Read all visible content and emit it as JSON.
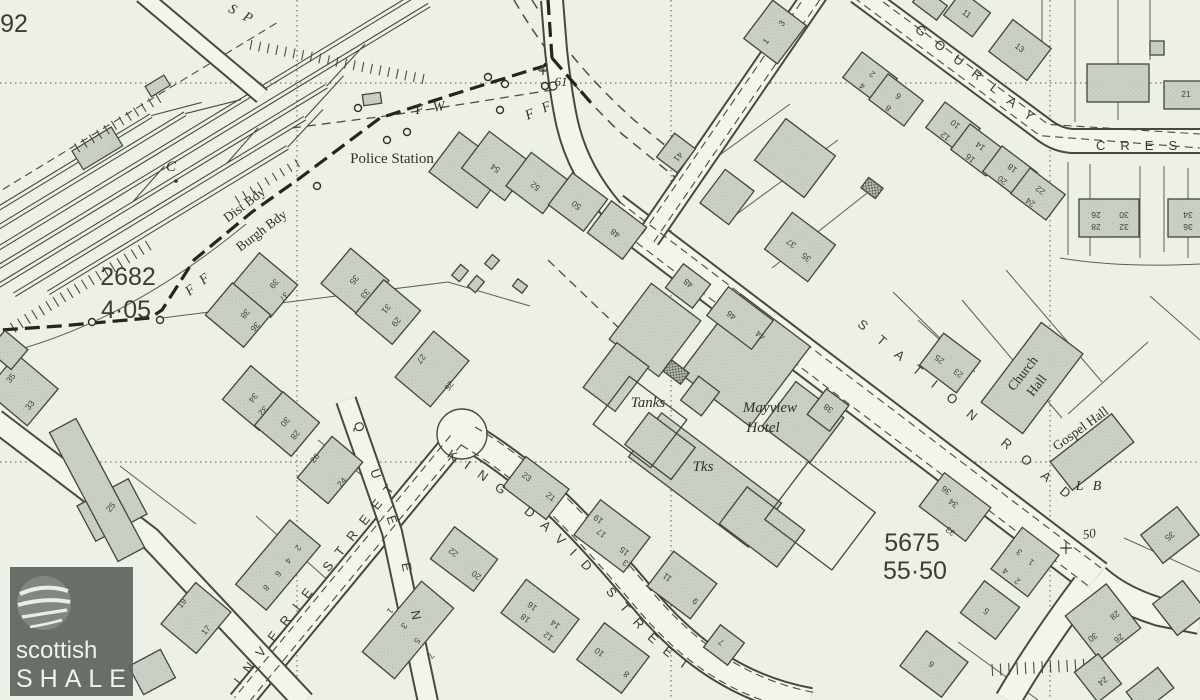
{
  "colors": {
    "paper": "#edf0e6",
    "ink": "#474b42",
    "building_fill": "#cbd0c6",
    "building_stroke": "#41453c",
    "road_fill": "#f3f5ec",
    "boundary": "#23261f",
    "watermark_bg": "#5f645e",
    "watermark_text": "#f1f2ee"
  },
  "watermark": {
    "line1": "scottish",
    "line2": "SHALE"
  },
  "map": {
    "street_labels": [
      {
        "t": "STATION ROAD",
        "path": "tp-station",
        "fs": 14,
        "sp": 16,
        "off": 40
      },
      {
        "t": "GOURLAY",
        "path": "tp-gourlay",
        "fs": 13,
        "sp": 14,
        "off": 18
      },
      {
        "t": "CRES",
        "path": "tp-cres",
        "fs": 13,
        "sp": 15,
        "off": 8
      },
      {
        "t": "KING DAVID STREET",
        "path": "tp-kingdavid",
        "fs": 13.5,
        "sp": 12,
        "off": 12
      },
      {
        "t": "INVERIE STREET",
        "path": "tp-inverie",
        "fs": 13,
        "sp": 11,
        "off": 26
      },
      {
        "t": "QUEEN",
        "path": "tp-queen",
        "fs": 13,
        "sp": 40,
        "off": 10
      }
    ],
    "place_labels": [
      {
        "t": "92",
        "x": 14,
        "y": 32,
        "r": 0,
        "s": "big"
      },
      {
        "t": "2682",
        "x": 128,
        "y": 285,
        "r": 0,
        "s": "big"
      },
      {
        "t": "4·05",
        "x": 126,
        "y": 318,
        "r": 0,
        "s": "big"
      },
      {
        "t": "5675",
        "x": 912,
        "y": 551,
        "r": 0,
        "s": "big"
      },
      {
        "t": "55·50",
        "x": 915,
        "y": 579,
        "r": 0,
        "s": "big"
      },
      {
        "t": "Police Station",
        "x": 392,
        "y": 163,
        "r": 0,
        "s": "serif"
      },
      {
        "t": "Dist Bdy",
        "x": 247,
        "y": 208,
        "r": -37,
        "s": "serif-s"
      },
      {
        "t": "Burgh Bdy",
        "x": 264,
        "y": 234,
        "r": -37,
        "s": "serif-s"
      },
      {
        "t": "F W",
        "x": 432,
        "y": 112,
        "r": -8,
        "s": "it-sp"
      },
      {
        "t": "F F",
        "x": 541,
        "y": 114,
        "r": -24,
        "s": "it-sp"
      },
      {
        "t": "F F",
        "x": 201,
        "y": 287,
        "r": -38,
        "s": "it-sp"
      },
      {
        "t": "S P",
        "x": 240,
        "y": 18,
        "r": 28,
        "s": "it-sp"
      },
      {
        "t": "C",
        "x": 171,
        "y": 171,
        "r": 0,
        "s": "it"
      },
      {
        "t": "61",
        "x": 561,
        "y": 86,
        "r": 0,
        "s": "it-s"
      },
      {
        "t": "50",
        "x": 1090,
        "y": 538,
        "r": -10,
        "s": "it-s"
      },
      {
        "t": "+",
        "x": 543,
        "y": 76,
        "r": 0,
        "s": "serif"
      },
      {
        "t": "+",
        "x": 1066,
        "y": 553,
        "r": 0,
        "s": "serif"
      },
      {
        "t": "Tanks",
        "x": 648,
        "y": 407,
        "r": 0,
        "s": "it"
      },
      {
        "t": "Tks",
        "x": 703,
        "y": 471,
        "r": 0,
        "s": "it"
      },
      {
        "t": "Mayview",
        "x": 770,
        "y": 412,
        "r": 0,
        "s": "it"
      },
      {
        "t": "Hotel",
        "x": 763,
        "y": 432,
        "r": 0,
        "s": "it"
      },
      {
        "t": "Church",
        "x": 1026,
        "y": 376,
        "r": -52,
        "s": "serif-s"
      },
      {
        "t": "Hall",
        "x": 1040,
        "y": 388,
        "r": -52,
        "s": "serif-s"
      },
      {
        "t": "Gospel Hall",
        "x": 1083,
        "y": 432,
        "r": -36,
        "s": "serif-s"
      },
      {
        "t": "L B",
        "x": 1090,
        "y": 490,
        "r": 0,
        "s": "it-sp"
      }
    ],
    "house_numbers": [
      [
        "54",
        497,
        166,
        -143
      ],
      [
        "52",
        537,
        184,
        -143
      ],
      [
        "50",
        578,
        203,
        -143
      ],
      [
        "48",
        617,
        231,
        -143
      ],
      [
        "37",
        793,
        241,
        -143
      ],
      [
        "35",
        808,
        255,
        -143
      ],
      [
        "25",
        941,
        357,
        -143
      ],
      [
        "23",
        960,
        371,
        -143
      ],
      [
        "2",
        874,
        72,
        -143
      ],
      [
        "4",
        864,
        84,
        -143
      ],
      [
        "6",
        900,
        94,
        -143
      ],
      [
        "8",
        890,
        106,
        -143
      ],
      [
        "10",
        957,
        122,
        -143
      ],
      [
        "12",
        947,
        134,
        -143
      ],
      [
        "14",
        982,
        144,
        -143
      ],
      [
        "16",
        972,
        156,
        -143
      ],
      [
        "18",
        1014,
        166,
        -143
      ],
      [
        "20",
        1004,
        178,
        -143
      ],
      [
        "22",
        1042,
        188,
        -143
      ],
      [
        "24",
        1032,
        200,
        -143
      ],
      [
        "11",
        965,
        16,
        37
      ],
      [
        "13",
        1018,
        50,
        37
      ],
      [
        "21",
        1186,
        97,
        0
      ],
      [
        "26",
        1096,
        212,
        180
      ],
      [
        "28",
        1096,
        224,
        180
      ],
      [
        "30",
        1124,
        212,
        180
      ],
      [
        "32",
        1124,
        224,
        180
      ],
      [
        "34",
        1188,
        212,
        180
      ],
      [
        "36",
        1188,
        224,
        180
      ],
      [
        "1",
        768,
        43,
        -53
      ],
      [
        "3",
        784,
        25,
        -53
      ],
      [
        "41",
        676,
        155,
        130
      ],
      [
        "48",
        690,
        281,
        -143
      ],
      [
        "46",
        733,
        313,
        -143
      ],
      [
        "44",
        762,
        333,
        -143
      ],
      [
        "38",
        830,
        406,
        -143
      ],
      [
        "23",
        525,
        479,
        37
      ],
      [
        "21",
        549,
        499,
        37
      ],
      [
        "22",
        455,
        550,
        -143
      ],
      [
        "20",
        478,
        573,
        -143
      ],
      [
        "19",
        600,
        517,
        -143
      ],
      [
        "17",
        603,
        531,
        -143
      ],
      [
        "15",
        626,
        549,
        -143
      ],
      [
        "13",
        629,
        562,
        -143
      ],
      [
        "16",
        534,
        604,
        -143
      ],
      [
        "18",
        527,
        616,
        -143
      ],
      [
        "14",
        557,
        622,
        -143
      ],
      [
        "12",
        550,
        634,
        -143
      ],
      [
        "10",
        601,
        650,
        -143
      ],
      [
        "8",
        628,
        672,
        -143
      ],
      [
        "11",
        669,
        575,
        -143
      ],
      [
        "9",
        697,
        599,
        -143
      ],
      [
        "7",
        723,
        640,
        -143
      ],
      [
        "5",
        988,
        609,
        -143
      ],
      [
        "6",
        933,
        662,
        -143
      ],
      [
        "4",
        1007,
        569,
        -143
      ],
      [
        "2",
        1019,
        579,
        -143
      ],
      [
        "3",
        1021,
        550,
        -143
      ],
      [
        "1",
        1033,
        560,
        -143
      ],
      [
        "33",
        952,
        529,
        -143
      ],
      [
        "36",
        948,
        488,
        -143
      ],
      [
        "34",
        955,
        501,
        -143
      ],
      [
        "35",
        1168,
        534,
        142
      ],
      [
        "30",
        1091,
        635,
        142
      ],
      [
        "28",
        1113,
        613,
        142
      ],
      [
        "26",
        1117,
        636,
        142
      ],
      [
        "24",
        1101,
        679,
        142
      ],
      [
        "26",
        317,
        460,
        -50
      ],
      [
        "24",
        344,
        484,
        -50
      ],
      [
        "1",
        388,
        609,
        130
      ],
      [
        "3",
        402,
        624,
        130
      ],
      [
        "5",
        415,
        639,
        130
      ],
      [
        "7",
        429,
        654,
        130
      ],
      [
        "8",
        264,
        586,
        130
      ],
      [
        "6",
        276,
        572,
        130
      ],
      [
        "4",
        286,
        559,
        130
      ],
      [
        "2",
        296,
        546,
        130
      ],
      [
        "19",
        184,
        605,
        -50
      ],
      [
        "17",
        208,
        632,
        -50
      ],
      [
        "25",
        113,
        509,
        -50
      ],
      [
        "35",
        13,
        380,
        -50
      ],
      [
        "33",
        32,
        407,
        -50
      ],
      [
        "35",
        352,
        278,
        130
      ],
      [
        "33",
        363,
        292,
        130
      ],
      [
        "31",
        384,
        307,
        130
      ],
      [
        "29",
        394,
        320,
        130
      ],
      [
        "27",
        419,
        357,
        130
      ],
      [
        "25",
        447,
        384,
        130
      ],
      [
        "39",
        272,
        282,
        130
      ],
      [
        "37",
        282,
        295,
        130
      ],
      [
        "38",
        243,
        312,
        130
      ],
      [
        "36",
        253,
        325,
        130
      ],
      [
        "34",
        251,
        396,
        130
      ],
      [
        "32",
        261,
        409,
        130
      ],
      [
        "30",
        283,
        420,
        130
      ],
      [
        "28",
        293,
        433,
        130
      ]
    ],
    "buildings": [
      [
        468,
        170,
        50,
        60,
        -53
      ],
      [
        497,
        166,
        54,
        46,
        37
      ],
      [
        537,
        183,
        46,
        42,
        37
      ],
      [
        578,
        202,
        44,
        40,
        37
      ],
      [
        617,
        230,
        44,
        40,
        37
      ],
      [
        800,
        247,
        54,
        46,
        37
      ],
      [
        950,
        363,
        46,
        40,
        37
      ],
      [
        775,
        32,
        48,
        42,
        -53
      ],
      [
        676,
        153,
        30,
        26,
        -53
      ],
      [
        795,
        158,
        62,
        52,
        37
      ],
      [
        727,
        197,
        36,
        42,
        37
      ],
      [
        872,
        188,
        18,
        13,
        37,
        "t"
      ],
      [
        870,
        78,
        44,
        32,
        37
      ],
      [
        896,
        100,
        44,
        32,
        37
      ],
      [
        953,
        128,
        44,
        32,
        37
      ],
      [
        978,
        150,
        44,
        32,
        37
      ],
      [
        1010,
        172,
        44,
        32,
        37
      ],
      [
        1038,
        194,
        44,
        32,
        37
      ],
      [
        967,
        14,
        36,
        30,
        37
      ],
      [
        1020,
        50,
        48,
        40,
        37
      ],
      [
        1157,
        48,
        14,
        14,
        0
      ],
      [
        1118,
        83,
        62,
        38,
        0
      ],
      [
        1186,
        95,
        44,
        28,
        0
      ],
      [
        1109,
        218,
        60,
        38,
        0
      ],
      [
        1189,
        218,
        42,
        38,
        0
      ],
      [
        1032,
        378,
        100,
        52,
        -53
      ],
      [
        1092,
        452,
        78,
        36,
        -38
      ],
      [
        745,
        360,
        88,
        100,
        37
      ],
      [
        803,
        422,
        60,
        56,
        37
      ],
      [
        655,
        330,
        62,
        70,
        37
      ],
      [
        616,
        377,
        40,
        56,
        37
      ],
      [
        700,
        396,
        26,
        30,
        37
      ],
      [
        740,
        318,
        56,
        36,
        37
      ],
      [
        828,
        410,
        28,
        32,
        37
      ],
      [
        688,
        286,
        34,
        30,
        37
      ],
      [
        676,
        372,
        22,
        14,
        37,
        "t"
      ],
      [
        705,
        480,
        150,
        55,
        37
      ],
      [
        762,
        527,
        72,
        46,
        37
      ],
      [
        660,
        446,
        58,
        40,
        37
      ],
      [
        536,
        488,
        54,
        38,
        37
      ],
      [
        612,
        536,
        62,
        44,
        37
      ],
      [
        464,
        559,
        54,
        40,
        37
      ],
      [
        540,
        616,
        66,
        42,
        37
      ],
      [
        613,
        658,
        56,
        46,
        37
      ],
      [
        682,
        585,
        54,
        44,
        37
      ],
      [
        724,
        645,
        30,
        28,
        37
      ],
      [
        934,
        664,
        52,
        44,
        37
      ],
      [
        990,
        610,
        44,
        40,
        37
      ],
      [
        1025,
        562,
        46,
        52,
        37
      ],
      [
        955,
        507,
        42,
        58,
        -53
      ],
      [
        1170,
        535,
        46,
        36,
        -38
      ],
      [
        1103,
        622,
        52,
        56,
        -38
      ],
      [
        1098,
        678,
        30,
        38,
        -38
      ],
      [
        1180,
        608,
        38,
        40,
        -38
      ],
      [
        330,
        470,
        54,
        40,
        -50
      ],
      [
        408,
        630,
        92,
        42,
        -50
      ],
      [
        278,
        565,
        84,
        40,
        -50
      ],
      [
        196,
        618,
        54,
        46,
        -50
      ],
      [
        112,
        510,
        40,
        58,
        62
      ],
      [
        97,
        490,
        146,
        30,
        62
      ],
      [
        22,
        390,
        48,
        54,
        -50
      ],
      [
        355,
        282,
        46,
        50,
        -50
      ],
      [
        388,
        312,
        44,
        48,
        -50
      ],
      [
        432,
        369,
        60,
        46,
        -50
      ],
      [
        265,
        285,
        42,
        50,
        -50
      ],
      [
        238,
        315,
        42,
        50,
        -50
      ],
      [
        255,
        398,
        44,
        48,
        -50
      ],
      [
        287,
        424,
        44,
        48,
        -50
      ],
      [
        8,
        350,
        26,
        30,
        -50
      ],
      [
        460,
        273,
        14,
        10,
        -50
      ],
      [
        476,
        284,
        14,
        10,
        -50
      ],
      [
        492,
        262,
        12,
        9,
        -50
      ],
      [
        520,
        286,
        12,
        9,
        37
      ],
      [
        152,
        672,
        32,
        36,
        62
      ],
      [
        930,
        4,
        30,
        18,
        37
      ],
      [
        1150,
        690,
        40,
        26,
        -38
      ],
      [
        372,
        99,
        18,
        11,
        -8
      ],
      [
        820,
        516,
        84,
        72,
        37,
        "w"
      ],
      [
        640,
        422,
        72,
        60,
        37,
        "w"
      ]
    ]
  }
}
